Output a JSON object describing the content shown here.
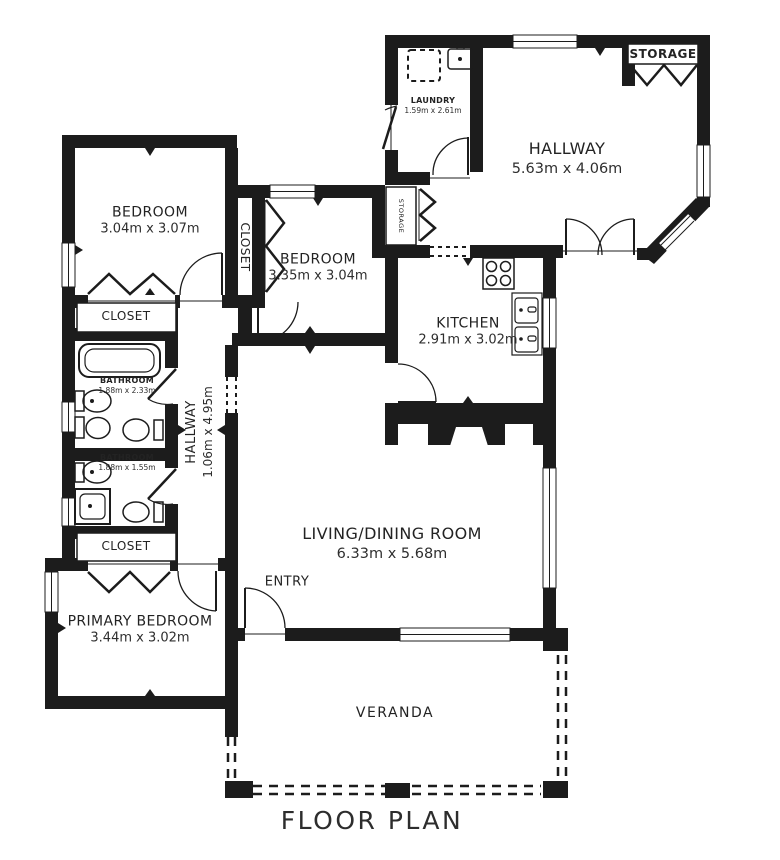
{
  "title": "FLOOR PLAN",
  "rooms": {
    "bedroom_1": {
      "name": "BEDROOM",
      "dims": "3.04m x 3.07m"
    },
    "bedroom_2": {
      "name": "BEDROOM",
      "dims": "3.35m x 3.04m"
    },
    "laundry": {
      "name": "LAUNDRY",
      "dims": "1.59m x 2.61m"
    },
    "hallway_top": {
      "name": "HALLWAY",
      "dims": "5.63m x 4.06m"
    },
    "storage_top": {
      "name": "STORAGE"
    },
    "storage_mid": {
      "name": "STORAGE"
    },
    "closet_vertical": {
      "name": "CLOSET"
    },
    "kitchen": {
      "name": "KITCHEN",
      "dims": "2.91m x 3.02m"
    },
    "closet_upper": {
      "name": "CLOSET"
    },
    "bathroom_1": {
      "name": "BATHROOM",
      "dims": "1.88m x 2.33m"
    },
    "hallway_vertical": {
      "name": "HALLWAY",
      "dims": "1.06m x 4.95m"
    },
    "bathroom_2": {
      "name": "BATHROOM",
      "dims": "1.88m x 1.55m"
    },
    "closet_lower": {
      "name": "CLOSET"
    },
    "primary_bedroom": {
      "name": "PRIMARY BEDROOM",
      "dims": "3.44m x 3.02m"
    },
    "living_dining": {
      "name": "LIVING/DINING ROOM",
      "dims": "6.33m x 5.68m"
    },
    "entry": {
      "name": "ENTRY"
    },
    "veranda": {
      "name": "VERANDA"
    }
  },
  "colors": {
    "wall": "#1c1c1c",
    "background": "#ffffff",
    "text": "#232323"
  }
}
